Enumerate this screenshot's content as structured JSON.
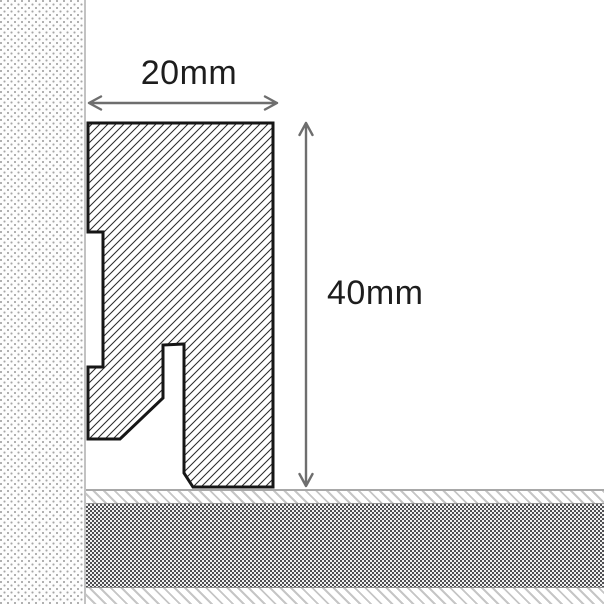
{
  "labels": {
    "width_dimension": "20mm",
    "height_dimension": "40mm"
  },
  "colors": {
    "outline_color": "#161616",
    "hatch_color": "#2b2b2b",
    "dimension_color": "#6e6e6e",
    "label_color": "#1d1d1d",
    "wall_dot_color": "#a6a6a6",
    "wall_bg_color": "#fdfdfd",
    "wall_edge_color": "#c2c2c2",
    "floor_line_color": "#a8a8a8",
    "floor_hatch_color": "#c6c6c6",
    "floor_dark_color": "#4f4f52",
    "page_bg": "#ffffff"
  }
}
